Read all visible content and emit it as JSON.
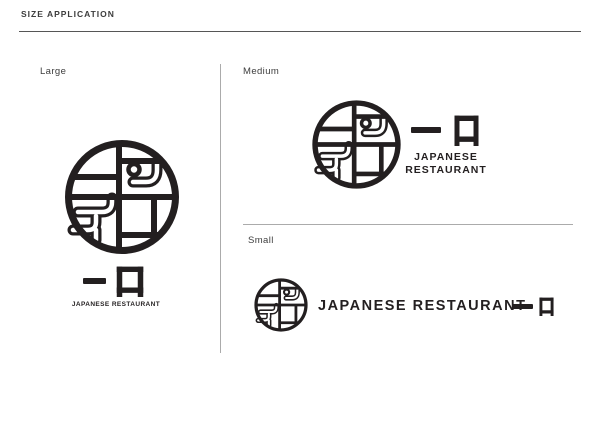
{
  "header": {
    "title": "SIZE APPLICATION"
  },
  "brand": {
    "kanji": "一口",
    "kanji_ichi": "一",
    "kanji_kuchi": "口",
    "name": "JAPANESE RESTAURANT",
    "name_line1": "JAPANESE",
    "name_line2": "RESTAURANT",
    "ink_color": "#231f20",
    "divider_color": "#ababab"
  },
  "sections": [
    {
      "id": "large",
      "label": "Large"
    },
    {
      "id": "medium",
      "label": "Medium"
    },
    {
      "id": "small",
      "label": "Small"
    }
  ]
}
